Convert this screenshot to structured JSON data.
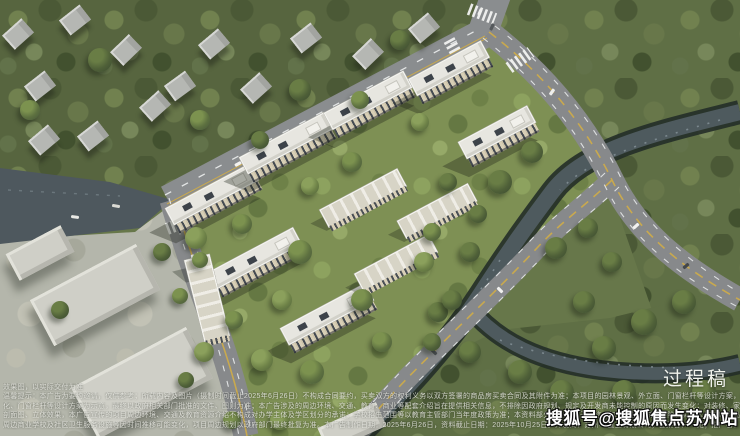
{
  "overlay": {
    "draft_label": "过程稿",
    "watermark": "搜狐号@搜狐焦点苏州站",
    "disclaimer_lines": [
      "效果图，以实际交付为准",
      "温馨提示：本广告为要约邀请，仅供参考；所载内容及图片（摄制时间截止2025年6月26日）不构成合同要约，买卖双方的权利义务以双方签署的商品房买卖合同及其附件为准；本项目的园林景观、外立面、门窗栏杆等设计方案，最终以政府批准的文件、图则为准。",
      "化、门窗栏杆等设计方案为示意，最终以政府相关部门批准的文件、图则为准；本广告涉及的周边环境、交通、教育、商业等配套介绍旨在提供相关信息，不排除因政府规划、规定及开发商未能控制的原因而发生变化；对装修、家具、家电等的展示不代表交付标准。",
      "剖面图、立体效果，本广告宣传的项目周边环境、交通及教育资源介绍不构成对办学主体及学区划分的承诺；学校招生范围等以教育主管部门当年度政策为准；本资料部分图片来源于网络，如有侵权请联系删除；买受人权益以商品房买卖合同约定为准，本广告内容不作为合同条款。",
      "周边商业学校及社区卫生服务设施等因时间推移可能变化，项目周边规划以政府部门最终批复为准。本广告制作日期：2025年6月26日，资料截止日期：2025年10月25日。开发商：苏州××置业有限公司；备案名：××苑；推广名：第二期组团。"
    ]
  },
  "colors": {
    "watermark_text": "#ffffff",
    "draft_label_text": "#f0f2ec",
    "road_marking_yellow": "#c9a94e",
    "river_water": "#4e5a5e",
    "tree_canopy": "#57653f"
  }
}
